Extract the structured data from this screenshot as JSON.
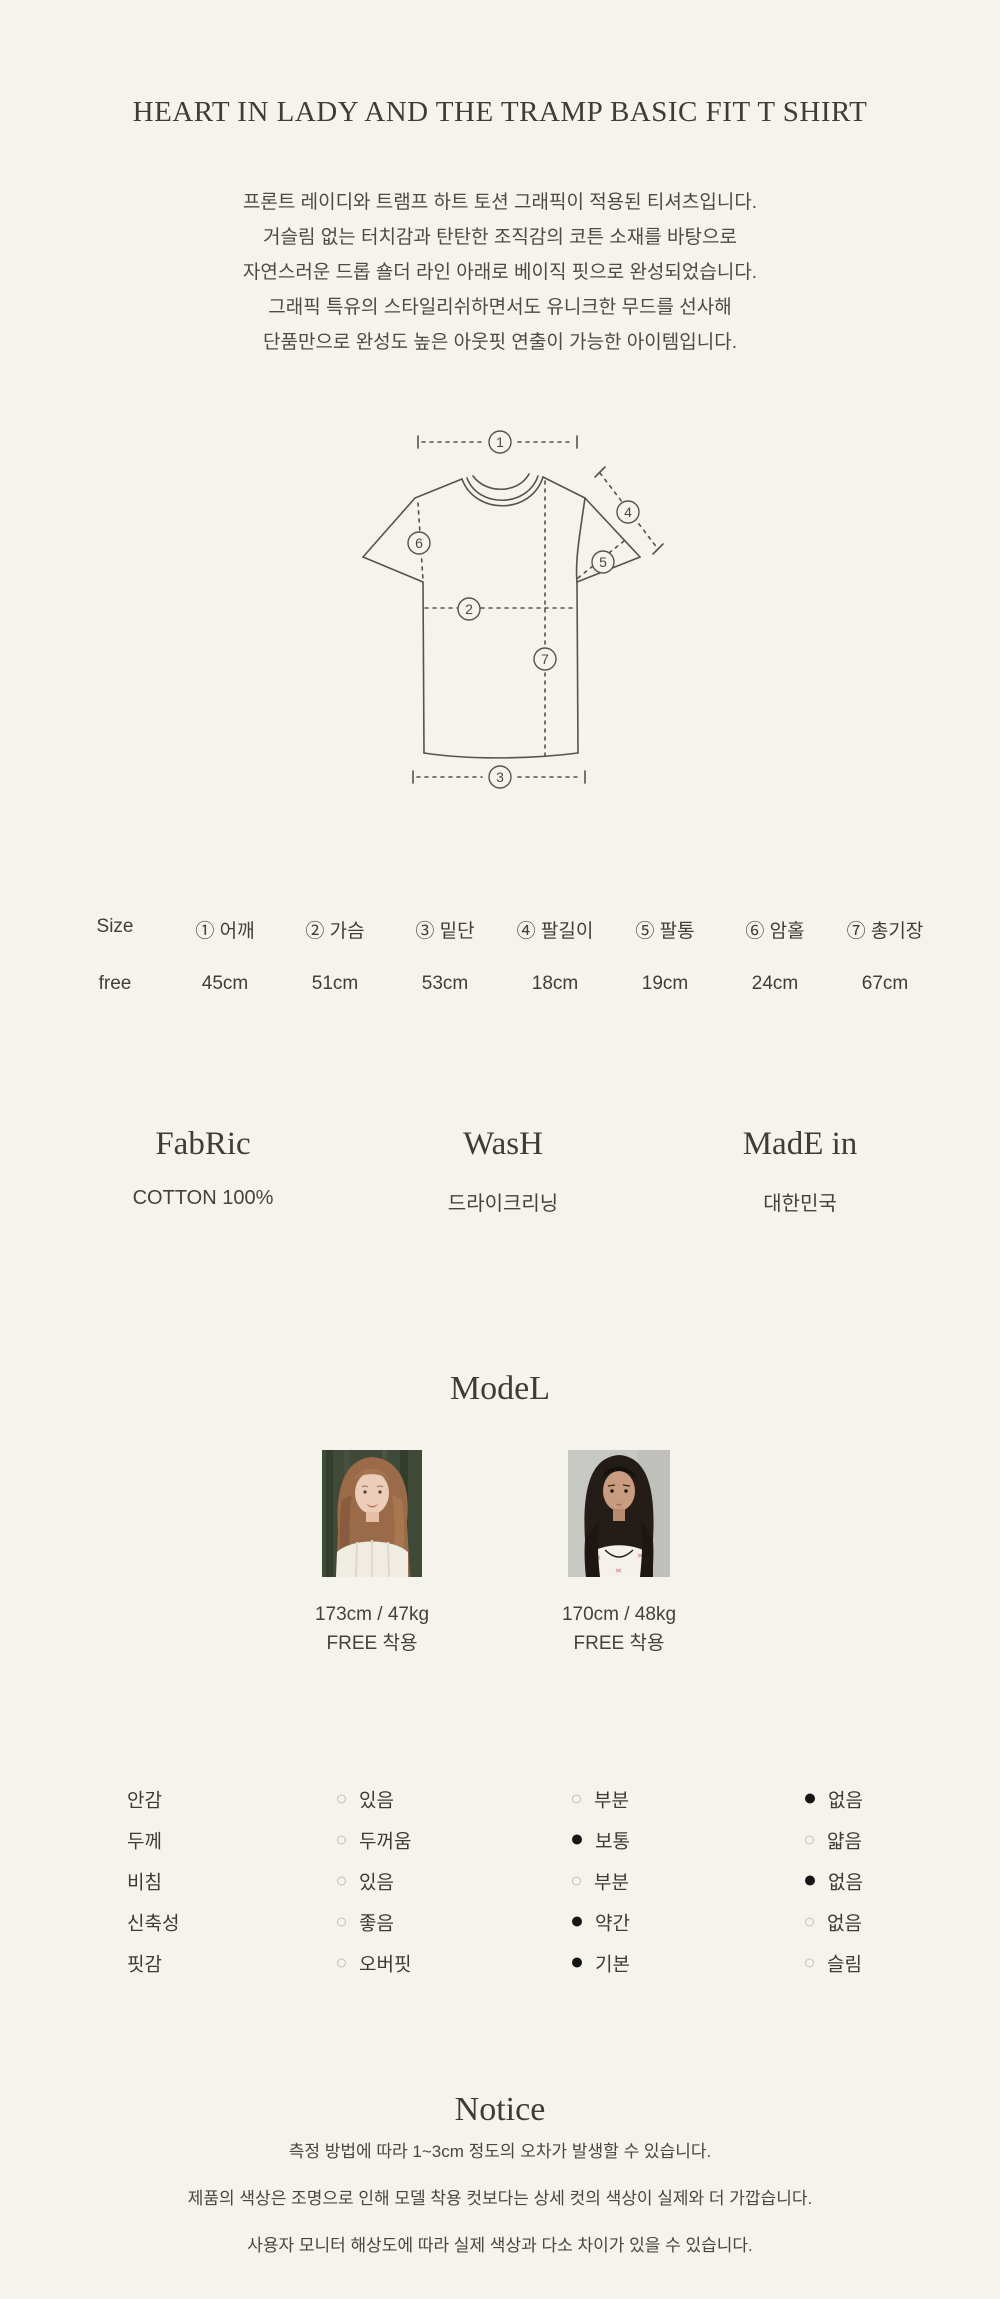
{
  "page": {
    "background_color": "#f5f4ec",
    "text_color": "#45453f",
    "radio_selected_color": "#161616"
  },
  "title": "HEART IN LADY AND THE TRAMP BASIC FIT T SHIRT",
  "description": {
    "lines": [
      "프론트 레이디와 트램프 하트 토션 그래픽이 적용된 티셔츠입니다.",
      "거슬림 없는 터치감과 탄탄한 조직감의 코튼 소재를 바탕으로",
      "자연스러운 드롭 숄더 라인 아래로 베이직 핏으로 완성되었습니다.",
      "그래픽 특유의 스타일리쉬하면서도 유니크한 무드를 선사해",
      "단품만으로 완성도 높은 아웃핏 연출이 가능한 아이템입니다."
    ]
  },
  "diagram": {
    "markers": [
      "1",
      "2",
      "3",
      "4",
      "5",
      "6",
      "7"
    ]
  },
  "size_table": {
    "columns": [
      "Size",
      "① 어깨",
      "② 가슴",
      "③ 밑단",
      "④ 팔길이",
      "⑤ 팔통",
      "⑥ 암홀",
      "⑦ 총기장"
    ],
    "rows": [
      [
        "free",
        "45cm",
        "51cm",
        "53cm",
        "18cm",
        "19cm",
        "24cm",
        "67cm"
      ]
    ]
  },
  "info_sections": [
    {
      "heading": "FabRic",
      "value": "COTTON 100%"
    },
    {
      "heading": "WasH",
      "value": "드라이크리닝"
    },
    {
      "heading": "MadE in",
      "value": "대한민국"
    }
  ],
  "model_section": {
    "heading": "ModeL",
    "models": [
      {
        "photo": "redhead-model",
        "stats": "173cm / 47kg",
        "fit": "FREE 착용"
      },
      {
        "photo": "dark-haired-model",
        "stats": "170cm / 48kg",
        "fit": "FREE 착용"
      }
    ]
  },
  "attributes": {
    "rows": [
      {
        "label": "안감",
        "options": [
          {
            "label": "있음",
            "selected": false
          },
          {
            "label": "부분",
            "selected": false
          },
          {
            "label": "없음",
            "selected": true
          }
        ]
      },
      {
        "label": "두께",
        "options": [
          {
            "label": "두꺼움",
            "selected": false
          },
          {
            "label": "보통",
            "selected": true
          },
          {
            "label": "얇음",
            "selected": false
          }
        ]
      },
      {
        "label": "비침",
        "options": [
          {
            "label": "있음",
            "selected": false
          },
          {
            "label": "부분",
            "selected": false
          },
          {
            "label": "없음",
            "selected": true
          }
        ]
      },
      {
        "label": "신축성",
        "options": [
          {
            "label": "좋음",
            "selected": false
          },
          {
            "label": "약간",
            "selected": true
          },
          {
            "label": "없음",
            "selected": false
          }
        ]
      },
      {
        "label": "핏감",
        "options": [
          {
            "label": "오버핏",
            "selected": false
          },
          {
            "label": "기본",
            "selected": true
          },
          {
            "label": "슬림",
            "selected": false
          }
        ]
      }
    ]
  },
  "notice": {
    "heading": "Notice",
    "lines": [
      "측정 방법에 따라 1~3cm 정도의 오차가 발생할 수 있습니다.",
      "제품의 색상은 조명으로 인해 모델 착용 컷보다는 상세 컷의 색상이 실제와 더 가깝습니다.",
      "사용자 모니터 해상도에 따라 실제 색상과 다소 차이가 있을 수 있습니다."
    ]
  }
}
